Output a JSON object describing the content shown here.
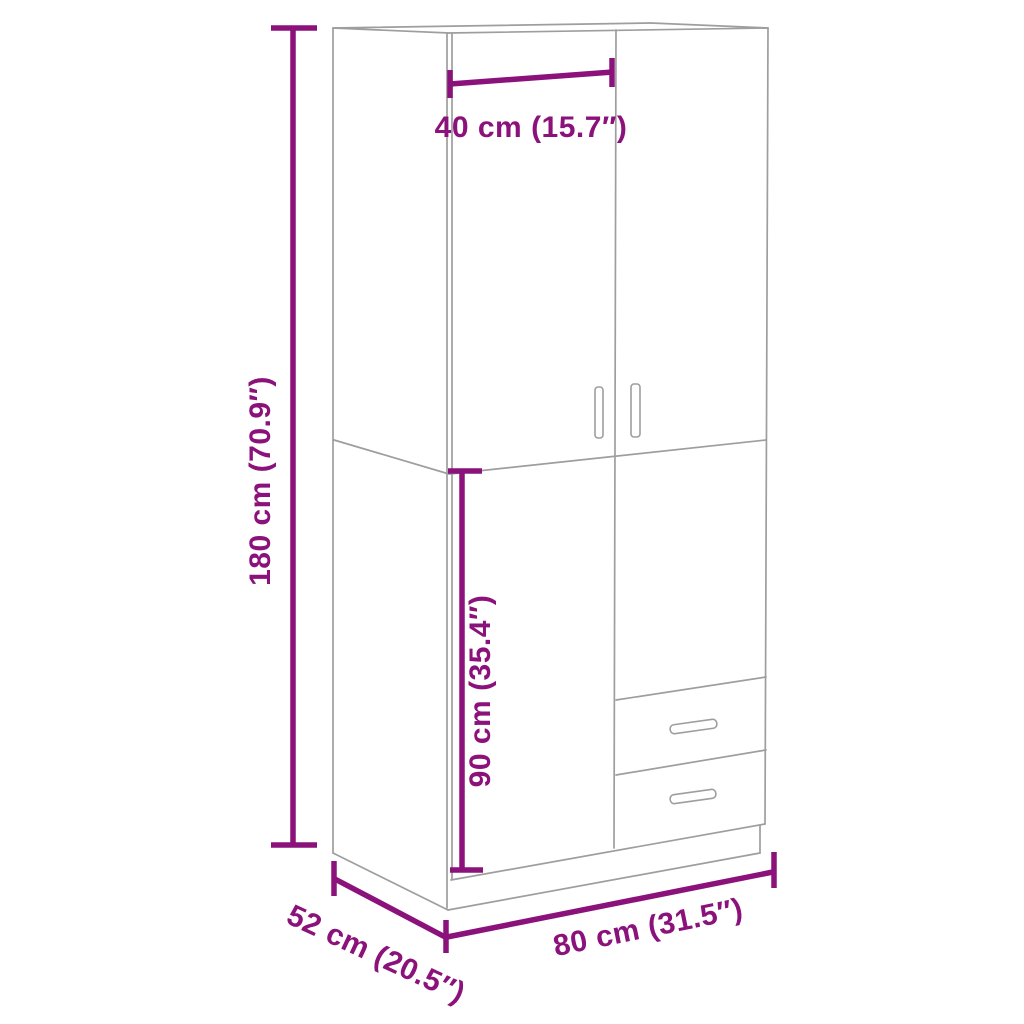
{
  "diagram": {
    "kind": "wardrobe-dimension-diagram",
    "background": "#FFFFFF",
    "accent_color": "#8B117B",
    "outline_color": "#9E9E9E",
    "dimensions": {
      "height": {
        "label": "180 cm (70.9″)",
        "cm": "180",
        "inches": "70.9"
      },
      "door_width": {
        "label": "40 cm (15.7″)",
        "cm": "40",
        "inches": "15.7"
      },
      "lower_section_height": {
        "label": "90 cm (35.4″)",
        "cm": "90",
        "inches": "35.4"
      },
      "width": {
        "label": "80 cm (31.5″)",
        "cm": "80",
        "inches": "31.5"
      },
      "depth": {
        "label": "52 cm (20.5″)",
        "cm": "52",
        "inches": "20.5"
      }
    }
  }
}
